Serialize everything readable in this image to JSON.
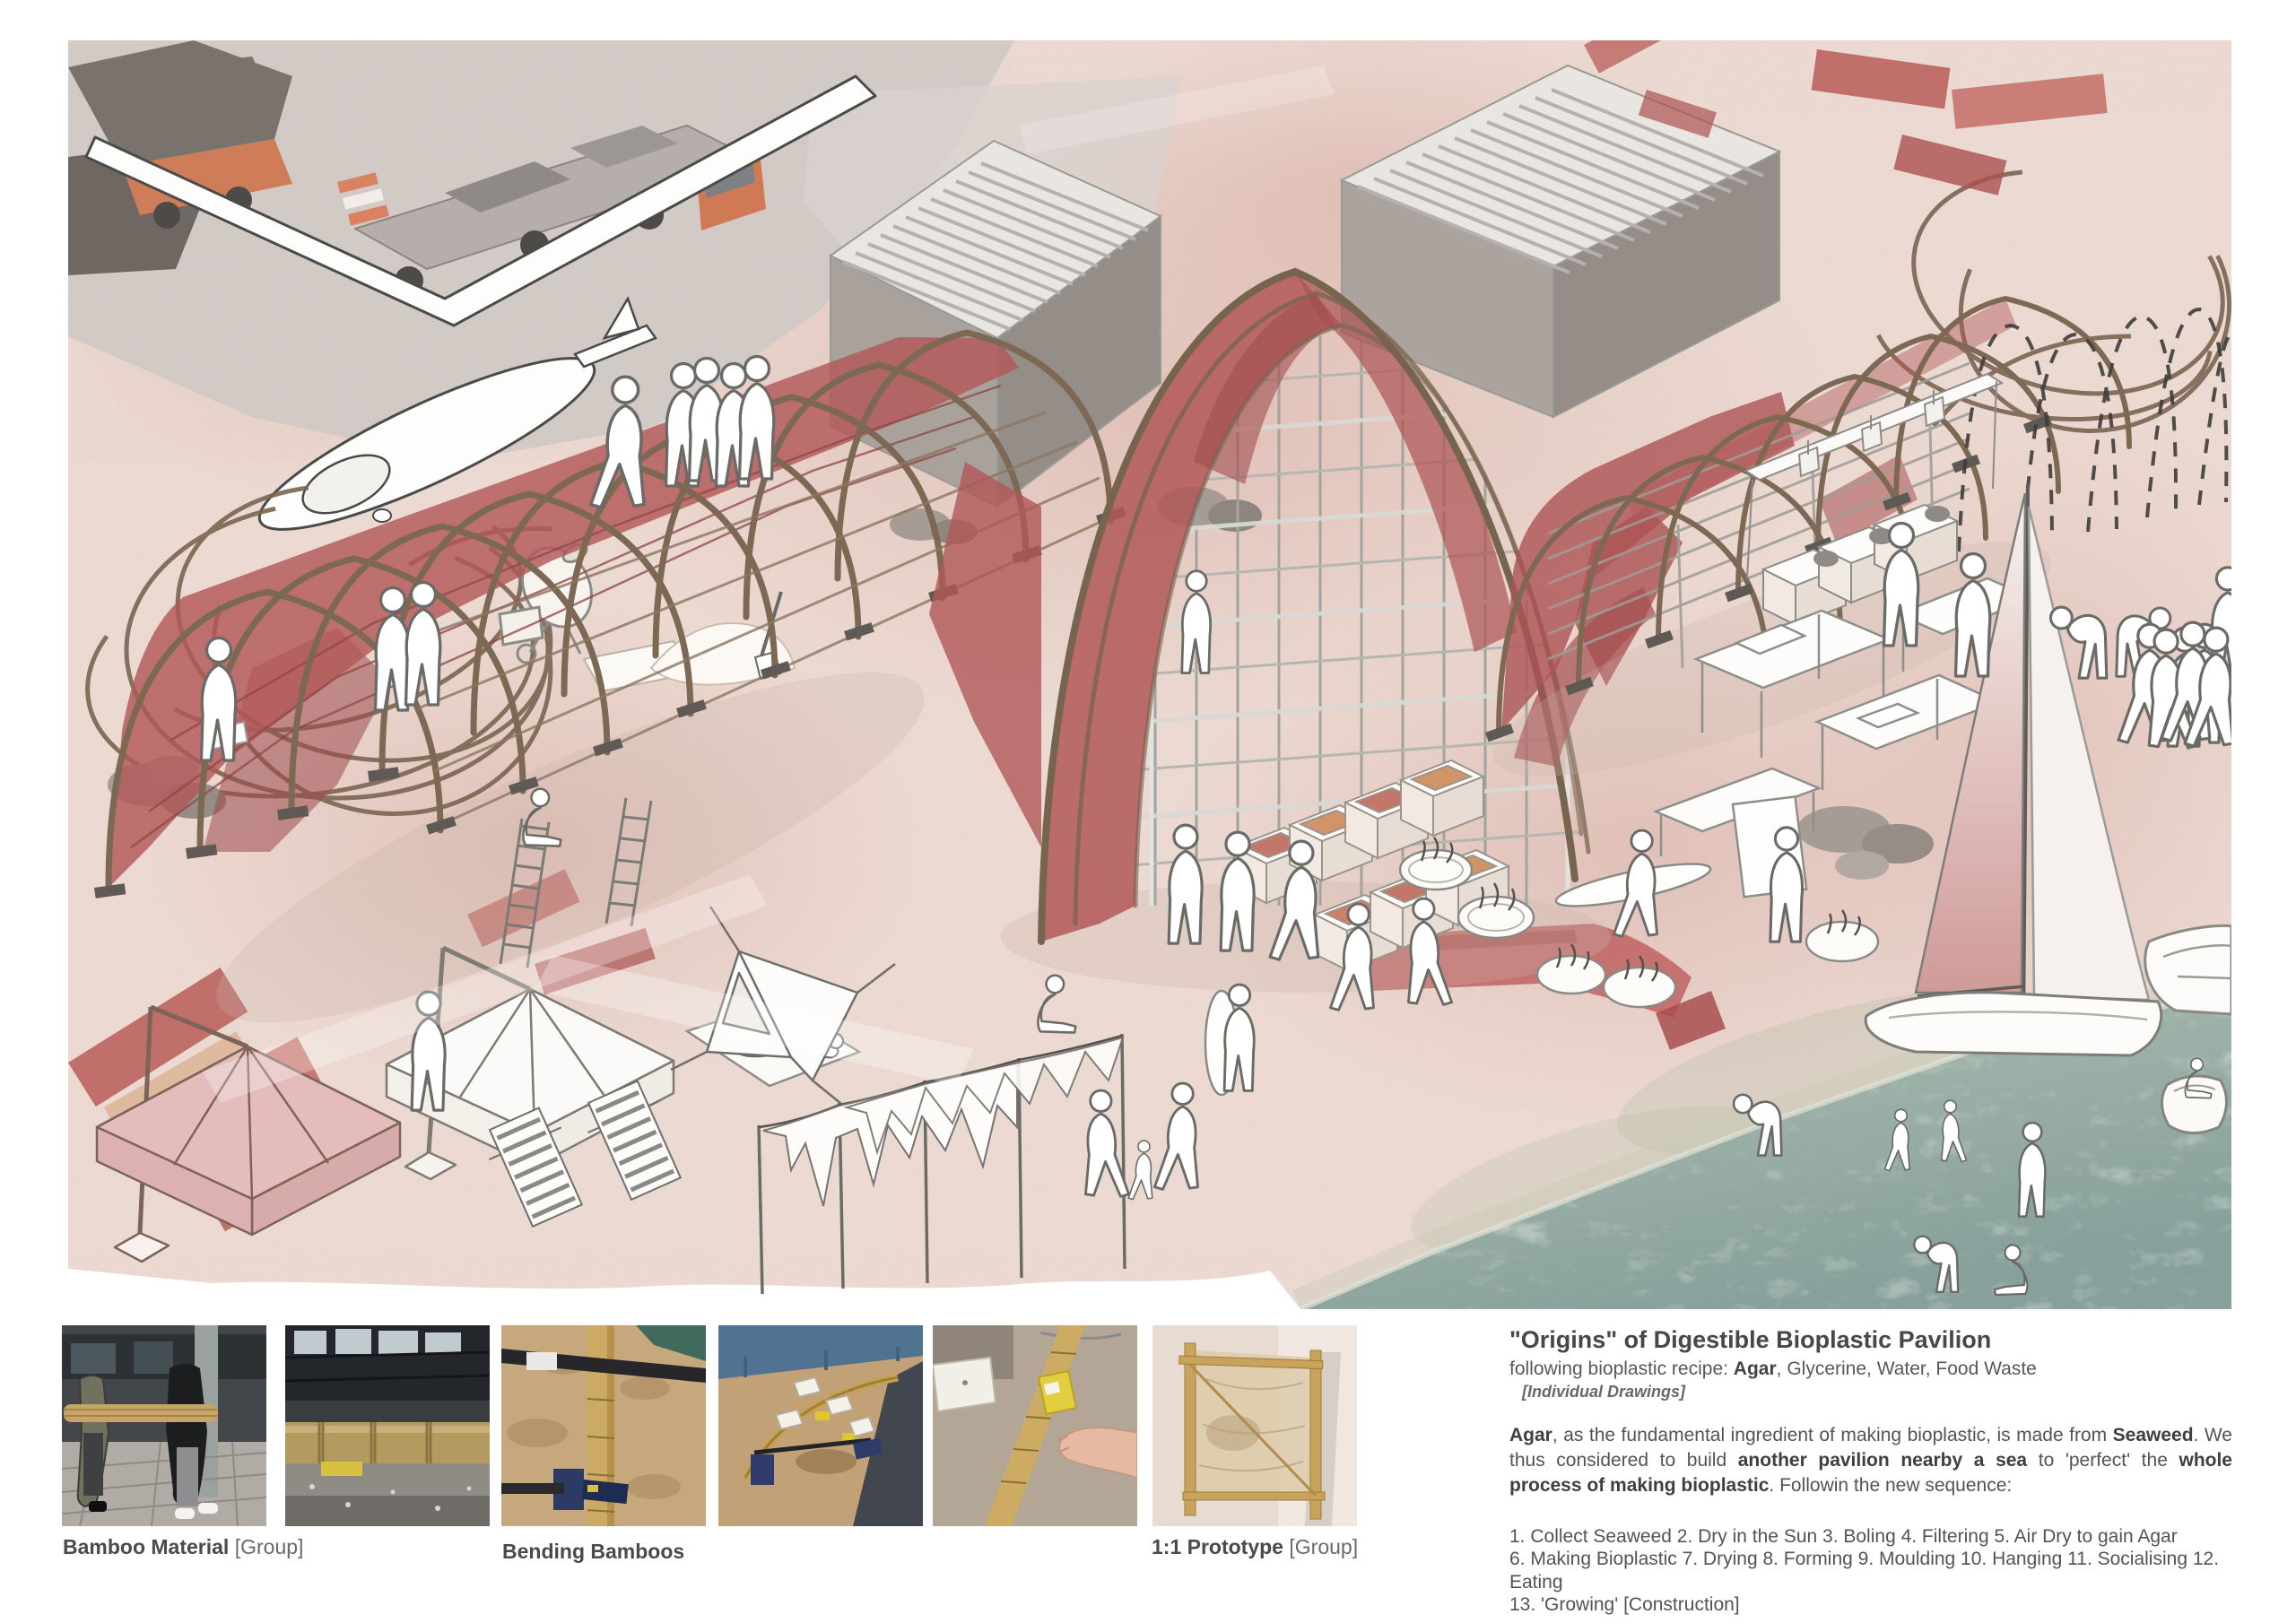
{
  "palette": {
    "sand": "#ecdbd3",
    "sand_wash": "#d8aca3",
    "bioplastic_red": "#b35a59",
    "bamboo_brown": "#7c6853",
    "sea_green": "#8ba49c",
    "container_grey": "#a9a29c",
    "truck_orange": "#d07a55",
    "title_text": "#474745",
    "body_text": "#55534f"
  },
  "photo_row": {
    "captions": [
      {
        "bold": "Bamboo Material",
        "rest": " [Group]"
      },
      {
        "bold": "Bending Bamboos",
        "rest": ""
      },
      {
        "bold": "1:1 Prototype",
        "rest": " [Group]"
      }
    ]
  },
  "description": {
    "title": "\"Origins\" of Digestible Bioplastic Pavilion",
    "recipe": {
      "prefix": "following bioplastic recipe: ",
      "bold": "Agar",
      "rest": ", Glycerine, Water, Food Waste"
    },
    "note": "[Individual Drawings]",
    "paragraph": [
      {
        "b": "Agar"
      },
      {
        "t": ", as the fundamental ingredient of making bioplastic,  is made from "
      },
      {
        "b": "Seaweed"
      },
      {
        "t": ". We thus considered to build "
      },
      {
        "b": "another pavilion nearby a sea"
      },
      {
        "t": " to 'perfect' the "
      },
      {
        "b": "whole process of making bioplastic"
      },
      {
        "t": ".  Followin the new sequence:"
      }
    ],
    "sequence": [
      "1. Collect Seaweed 2. Dry in the Sun 3. Boling 4. Filtering 5. Air Dry to gain Agar",
      "6. Making Bioplastic 7. Drying 8. Forming 9. Moulding 10. Hanging 11. Socialising 12. Eating",
      "13. 'Growing' [Construction]"
    ]
  }
}
